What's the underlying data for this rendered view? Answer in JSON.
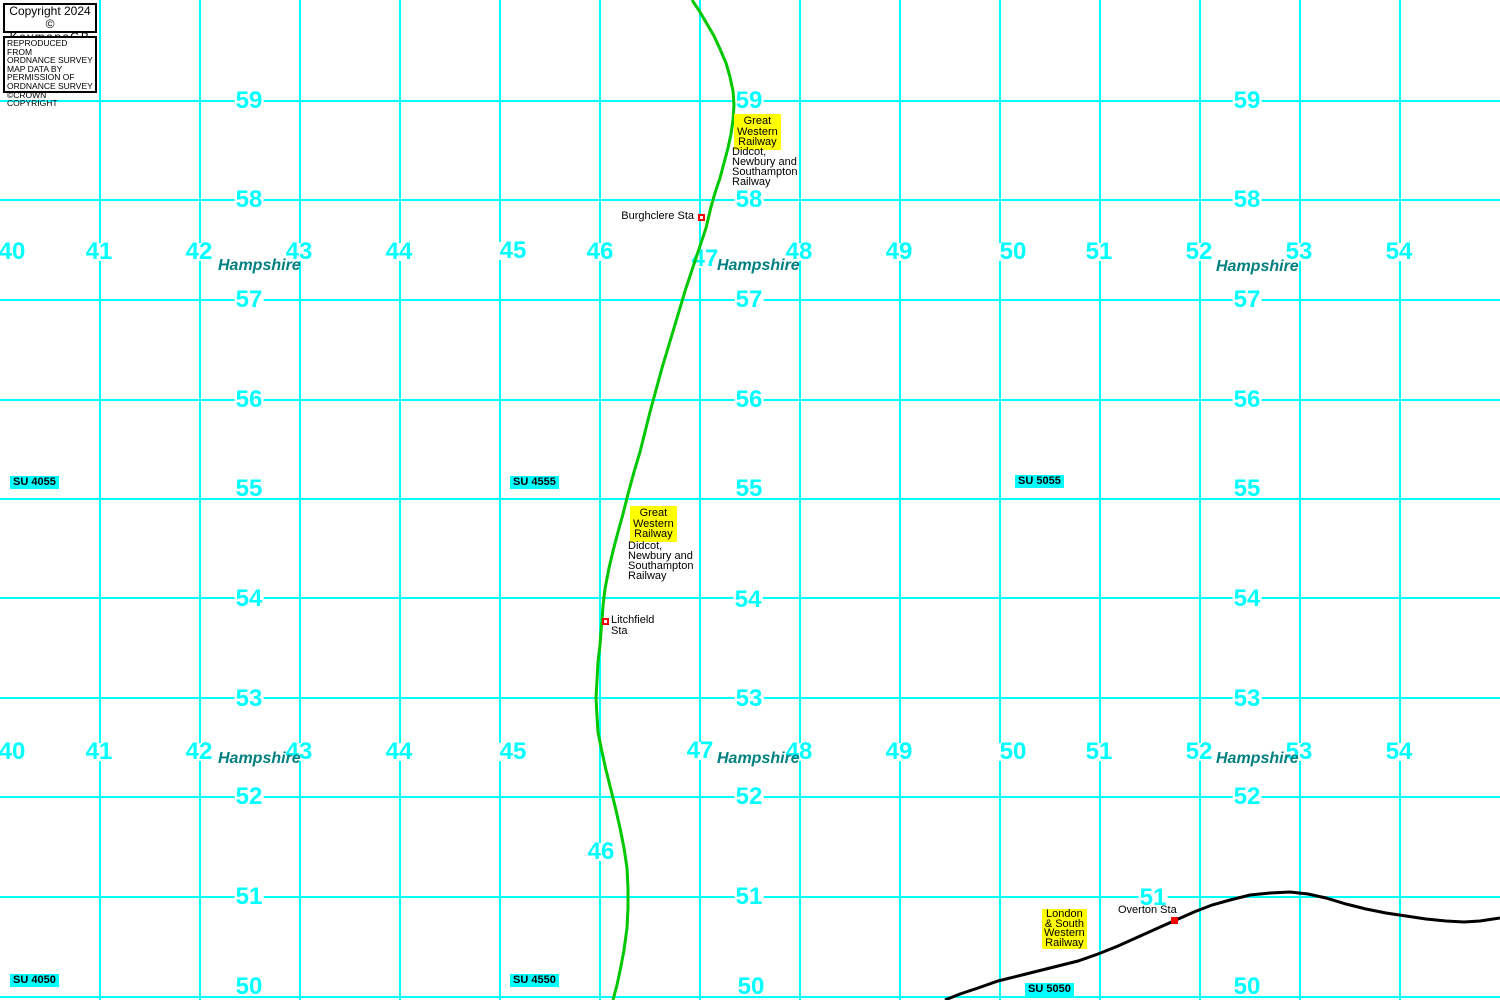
{
  "colors": {
    "grid": "#00ffff",
    "grid_number": "#00ffff",
    "county": "#008080",
    "su_bg": "#00ffff",
    "highlight_bg": "#ffff00",
    "gwr_line": "#00c800",
    "lswr_line": "#000000",
    "station_marker": "#ff0000"
  },
  "copyright": {
    "title_line1": "Copyright 2024 ©",
    "title_line2": "KeymapsGB",
    "notice_lines": [
      "REPRODUCED FROM",
      "ORDNANCE SURVEY",
      "MAP DATA BY",
      "PERMISSION OF",
      "ORDNANCE SURVEY",
      "©CROWN COPYRIGHT"
    ]
  },
  "grid": {
    "vlines_x": [
      100,
      200,
      300,
      400,
      500,
      600,
      700,
      800,
      900,
      1000,
      1100,
      1200,
      1300,
      1400
    ],
    "hlines_y": [
      101,
      200,
      300,
      400,
      499,
      598,
      698,
      797,
      897,
      997
    ],
    "column_numbers": [
      {
        "t": "40",
        "x": 12,
        "y": 252
      },
      {
        "t": "41",
        "x": 99,
        "y": 252
      },
      {
        "t": "42",
        "x": 199,
        "y": 252
      },
      {
        "t": "43",
        "x": 299,
        "y": 252
      },
      {
        "t": "44",
        "x": 399,
        "y": 252
      },
      {
        "t": "45",
        "x": 513,
        "y": 251
      },
      {
        "t": "46",
        "x": 600,
        "y": 252
      },
      {
        "t": "47",
        "x": 705,
        "y": 259
      },
      {
        "t": "48",
        "x": 799,
        "y": 252
      },
      {
        "t": "49",
        "x": 899,
        "y": 252
      },
      {
        "t": "50",
        "x": 1013,
        "y": 252
      },
      {
        "t": "51",
        "x": 1099,
        "y": 252
      },
      {
        "t": "52",
        "x": 1199,
        "y": 252
      },
      {
        "t": "53",
        "x": 1299,
        "y": 252
      },
      {
        "t": "54",
        "x": 1399,
        "y": 252
      },
      {
        "t": "40",
        "x": 12,
        "y": 752
      },
      {
        "t": "41",
        "x": 99,
        "y": 752
      },
      {
        "t": "42",
        "x": 199,
        "y": 752
      },
      {
        "t": "43",
        "x": 299,
        "y": 752
      },
      {
        "t": "44",
        "x": 399,
        "y": 752
      },
      {
        "t": "45",
        "x": 513,
        "y": 752
      },
      {
        "t": "46",
        "x": 601,
        "y": 852
      },
      {
        "t": "47",
        "x": 700,
        "y": 751
      },
      {
        "t": "48",
        "x": 799,
        "y": 752
      },
      {
        "t": "49",
        "x": 899,
        "y": 752
      },
      {
        "t": "50",
        "x": 1013,
        "y": 752
      },
      {
        "t": "51",
        "x": 1099,
        "y": 752
      },
      {
        "t": "52",
        "x": 1199,
        "y": 752
      },
      {
        "t": "53",
        "x": 1299,
        "y": 752
      },
      {
        "t": "54",
        "x": 1399,
        "y": 752
      }
    ],
    "row_numbers": [
      {
        "t": "59",
        "x": 249,
        "y": 101
      },
      {
        "t": "58",
        "x": 249,
        "y": 200
      },
      {
        "t": "57",
        "x": 249,
        "y": 300
      },
      {
        "t": "56",
        "x": 249,
        "y": 400
      },
      {
        "t": "55",
        "x": 249,
        "y": 489
      },
      {
        "t": "54",
        "x": 249,
        "y": 599
      },
      {
        "t": "53",
        "x": 249,
        "y": 699
      },
      {
        "t": "52",
        "x": 249,
        "y": 797
      },
      {
        "t": "51",
        "x": 249,
        "y": 897
      },
      {
        "t": "50",
        "x": 249,
        "y": 987
      },
      {
        "t": "59",
        "x": 749,
        "y": 101
      },
      {
        "t": "58",
        "x": 749,
        "y": 200
      },
      {
        "t": "57",
        "x": 749,
        "y": 300
      },
      {
        "t": "56",
        "x": 749,
        "y": 400
      },
      {
        "t": "55",
        "x": 749,
        "y": 489
      },
      {
        "t": "54",
        "x": 748,
        "y": 600
      },
      {
        "t": "53",
        "x": 749,
        "y": 699
      },
      {
        "t": "52",
        "x": 749,
        "y": 797
      },
      {
        "t": "51",
        "x": 749,
        "y": 897
      },
      {
        "t": "50",
        "x": 751,
        "y": 987
      },
      {
        "t": "59",
        "x": 1247,
        "y": 101
      },
      {
        "t": "58",
        "x": 1247,
        "y": 200
      },
      {
        "t": "57",
        "x": 1247,
        "y": 300
      },
      {
        "t": "56",
        "x": 1247,
        "y": 400
      },
      {
        "t": "55",
        "x": 1247,
        "y": 489
      },
      {
        "t": "54",
        "x": 1247,
        "y": 599
      },
      {
        "t": "53",
        "x": 1247,
        "y": 699
      },
      {
        "t": "52",
        "x": 1247,
        "y": 797
      },
      {
        "t": "51",
        "x": 1153,
        "y": 898
      },
      {
        "t": "50",
        "x": 1247,
        "y": 987
      }
    ],
    "county_labels": [
      {
        "t": "Hampshire",
        "x": 218,
        "y": 259
      },
      {
        "t": "Hampshire",
        "x": 717,
        "y": 259
      },
      {
        "t": "Hampshire",
        "x": 1216,
        "y": 260
      },
      {
        "t": "Hampshire",
        "x": 218,
        "y": 752
      },
      {
        "t": "Hampshire",
        "x": 717,
        "y": 752
      },
      {
        "t": "Hampshire",
        "x": 1216,
        "y": 752
      }
    ],
    "su_refs": [
      {
        "t": "SU 4055",
        "x": 10,
        "y": 476
      },
      {
        "t": "SU 4555",
        "x": 510,
        "y": 476
      },
      {
        "t": "SU 5055",
        "x": 1015,
        "y": 475
      },
      {
        "t": "SU 4050",
        "x": 10,
        "y": 974
      },
      {
        "t": "SU 4550",
        "x": 510,
        "y": 974
      },
      {
        "t": "SU 5050",
        "x": 1025,
        "y": 983
      }
    ]
  },
  "railways": [
    {
      "name": "Great Western Railway (Didcot, Newbury and Southampton Railway)",
      "color_key": "gwr_line",
      "points": "692,0 700,12 707,24 714,36 720,49 726,63 730,77 733,91 734,105 733,120 731,134 728,148 724,163 720,178 715,193 711,207 706,228 701,243 696,258 691,273 686,288 680,308 674,328 668,348 662,368 656,390 650,412 645,432 640,452 634,472 628,494 623,514 618,532 613,551 609,568 605,589 603,606 602,620 601,632 600,645 598,662 597,680 596,698 597,716 598,732 602,752 606,770 611,790 615,806 620,828 624,848 627,868 628,888 628,908 627,928 624,950 621,966 617,985 613,1000",
      "labels": [
        {
          "box_lines": [
            "Great",
            "Western",
            "Railway"
          ],
          "box_x": 734,
          "box_y": 114,
          "desc_lines": [
            "Didcot,",
            "Newbury and",
            "Southampton",
            "Railway"
          ],
          "desc_x": 732,
          "desc_y": 147
        },
        {
          "box_lines": [
            "Great",
            "Western",
            "Railway"
          ],
          "box_x": 630,
          "box_y": 506,
          "desc_lines": [
            "Didcot,",
            "Newbury and",
            "Southampton",
            "Railway"
          ],
          "desc_x": 628,
          "desc_y": 541
        }
      ],
      "stations": [
        {
          "name": "Burghclere Sta",
          "lines": [
            "Burghclere Sta"
          ],
          "marker_x": 698,
          "marker_y": 214,
          "marker_style": "outline",
          "text_x": 694,
          "text_y": 211,
          "align": "right"
        },
        {
          "name": "Litchfield Sta",
          "lines": [
            "Litchfield",
            "Sta"
          ],
          "marker_x": 602,
          "marker_y": 618,
          "marker_style": "outline",
          "text_x": 611,
          "text_y": 615,
          "align": "left"
        }
      ]
    },
    {
      "name": "London & South Western Railway",
      "color_key": "lswr_line",
      "points": "945,1000 960,994 978,988 998,981 1018,976 1038,971 1058,966 1078,961 1098,954 1118,946 1138,937 1158,928 1176,920 1194,912 1212,905 1230,900 1250,895 1270,893 1290,892 1308,894 1326,898 1346,904 1366,909 1386,913 1406,916 1426,919 1446,921 1464,922 1480,921 1500,918",
      "labels": [
        {
          "box_lines": [
            "London",
            "& South",
            "Western",
            "Railway"
          ],
          "box_x": 1042,
          "box_y": 909
        }
      ],
      "stations": [
        {
          "name": "Overton Sta",
          "lines": [
            "Overton Sta"
          ],
          "marker_x": 1171,
          "marker_y": 917,
          "marker_style": "filled",
          "text_x": 1118,
          "text_y": 905,
          "align": "left"
        }
      ]
    }
  ]
}
